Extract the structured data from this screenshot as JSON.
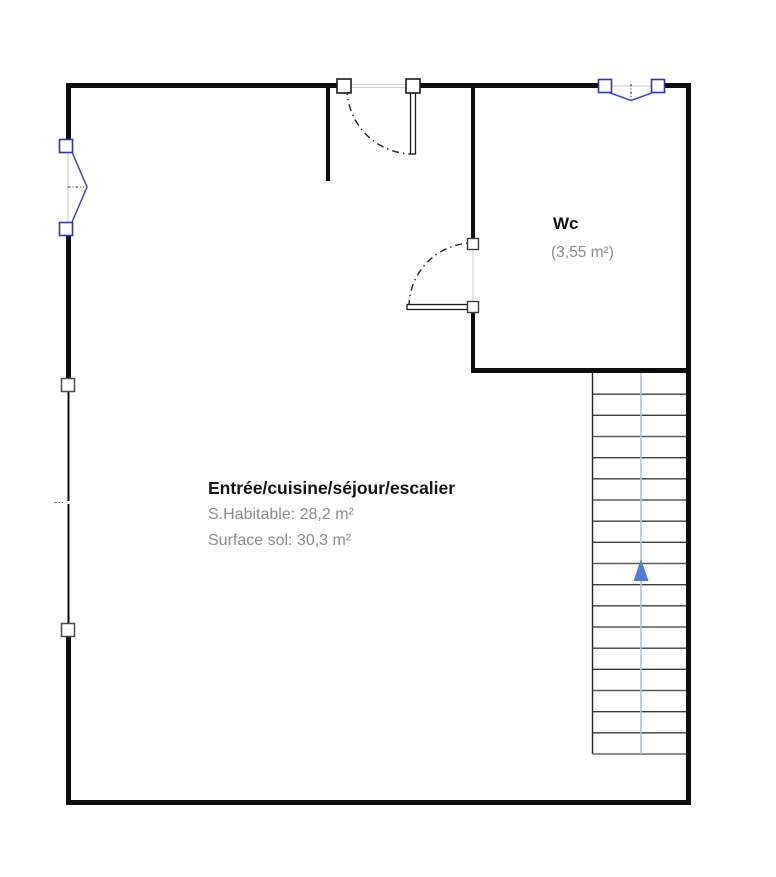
{
  "plan": {
    "type": "floor-plan",
    "rooms": {
      "main": {
        "name": "Entrée/cuisine/séjour/escalier",
        "habitable_label": "S.Habitable: 28,2 m²",
        "floor_label": "Surface sol: 30,3 m²"
      },
      "wc": {
        "name": "Wc",
        "area_label": "(3,55 m²)"
      }
    },
    "stairs": {
      "steps": 18,
      "direction": "up"
    },
    "colors": {
      "wall": "#0d0d0d",
      "window_blue": "#3a48c0",
      "window_square_border": "#2b38b4",
      "stair_guide": "#a9c5e6",
      "stair_arrow": "#4d7dd6",
      "label_black": "#141414",
      "label_gray": "#8a8a8a",
      "opening_gray": "#d2d2d2"
    }
  }
}
